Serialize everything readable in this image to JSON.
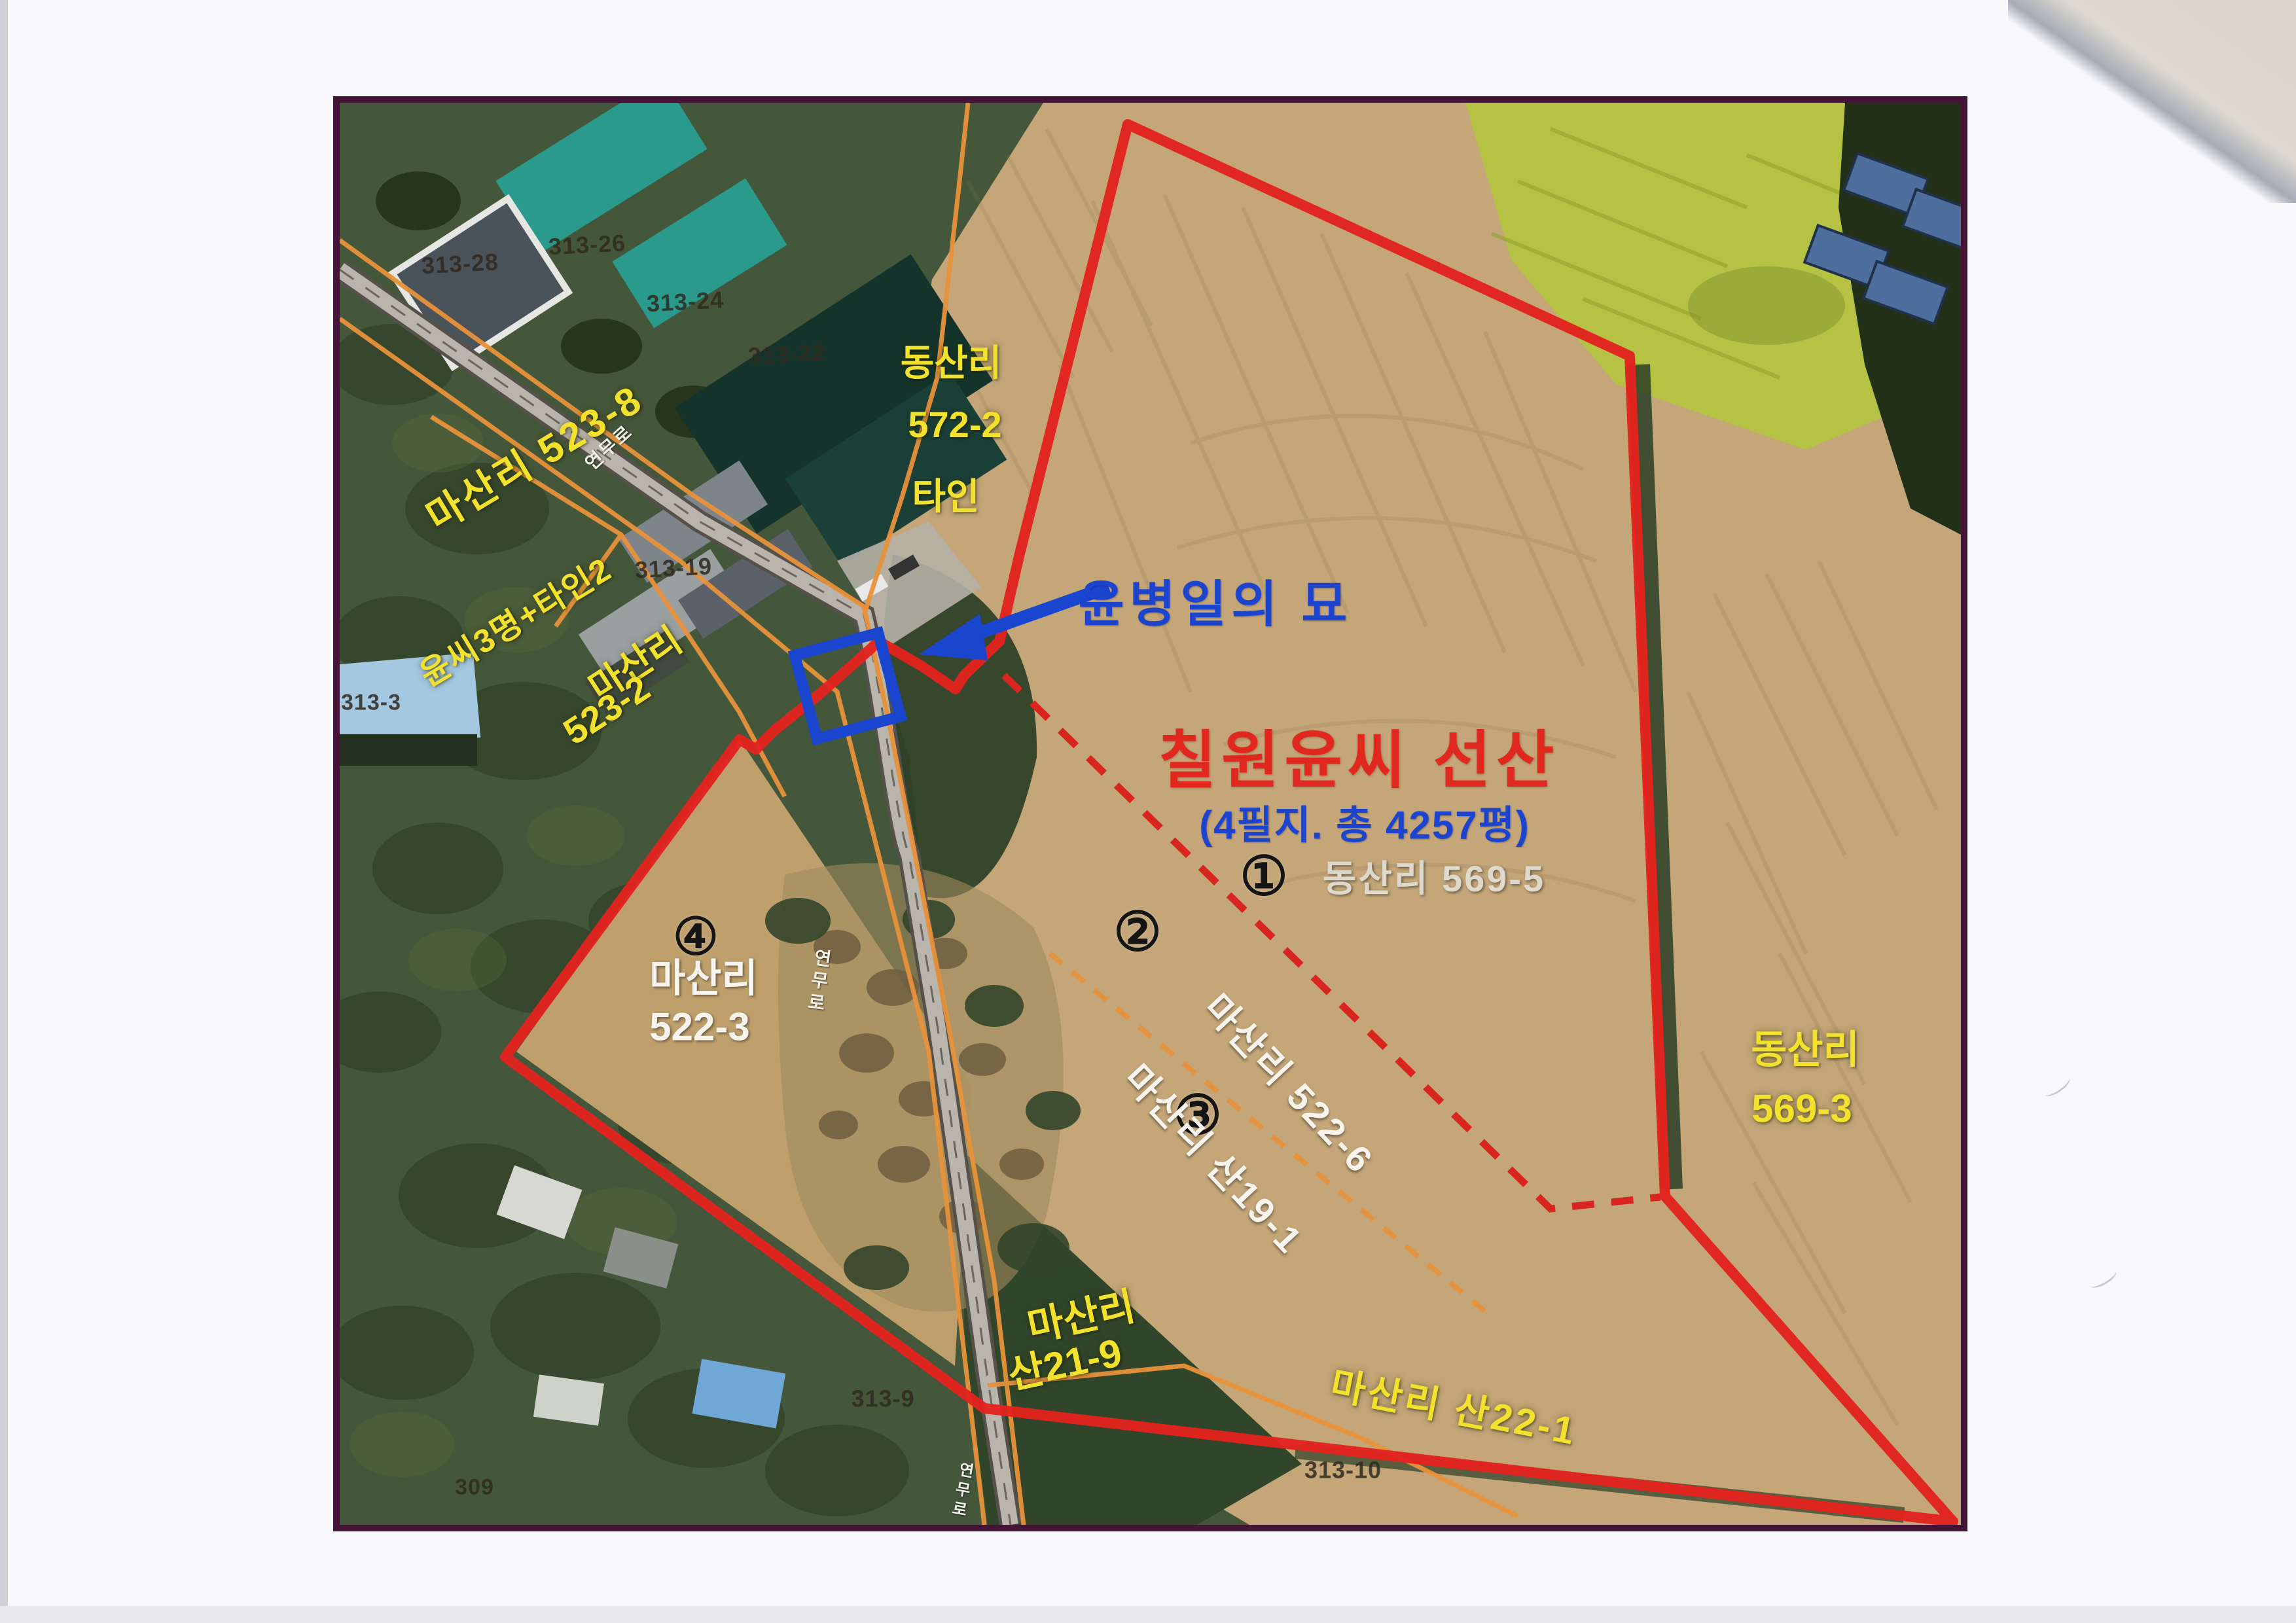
{
  "map": {
    "title": "칠원윤씨 선산",
    "subtitle": "(4필지. 총 4257평)",
    "grave_marker_label": "윤병일의 묘",
    "numbered_parcels": [
      {
        "num": "①",
        "label": "동산리 569-5"
      },
      {
        "num": "②",
        "label": "마산리 522-6"
      },
      {
        "num": "③",
        "label": "마산리 산19-1"
      },
      {
        "num": "④",
        "line1": "마산리",
        "line2": "522-3"
      }
    ],
    "area_labels": {
      "masanri_523_8": {
        "line1": "마산리 523-8",
        "line2": "윤씨3명+타인2"
      },
      "dongsanri_572_2": {
        "line1": "동산리",
        "line2": "572-2",
        "line3": "타인"
      },
      "masanri_523_2": {
        "line1": "마산리",
        "line2": "523-2"
      },
      "dongsanri_569_3": {
        "line1": "동산리",
        "line2": "569-3"
      },
      "masanri_san21_9": {
        "line1": "마산리",
        "line2": "산21-9"
      },
      "masanri_san22_1": {
        "label": "마산리 산22-1"
      }
    },
    "road_name": "연무로",
    "cadastral_numbers": [
      "313-28",
      "313-26",
      "313-24",
      "313-22",
      "313-19",
      "313-3",
      "313-9",
      "313-10",
      "309"
    ],
    "colors": {
      "boundary_red": "#e2231f",
      "marker_blue": "#1a46cf",
      "cadastral_orange": "#e8923a",
      "label_yellow": "#f2e22e",
      "title_red": "#e0281e",
      "subtitle_blue": "#1d44cf",
      "frame_maroon": "#451537"
    }
  }
}
